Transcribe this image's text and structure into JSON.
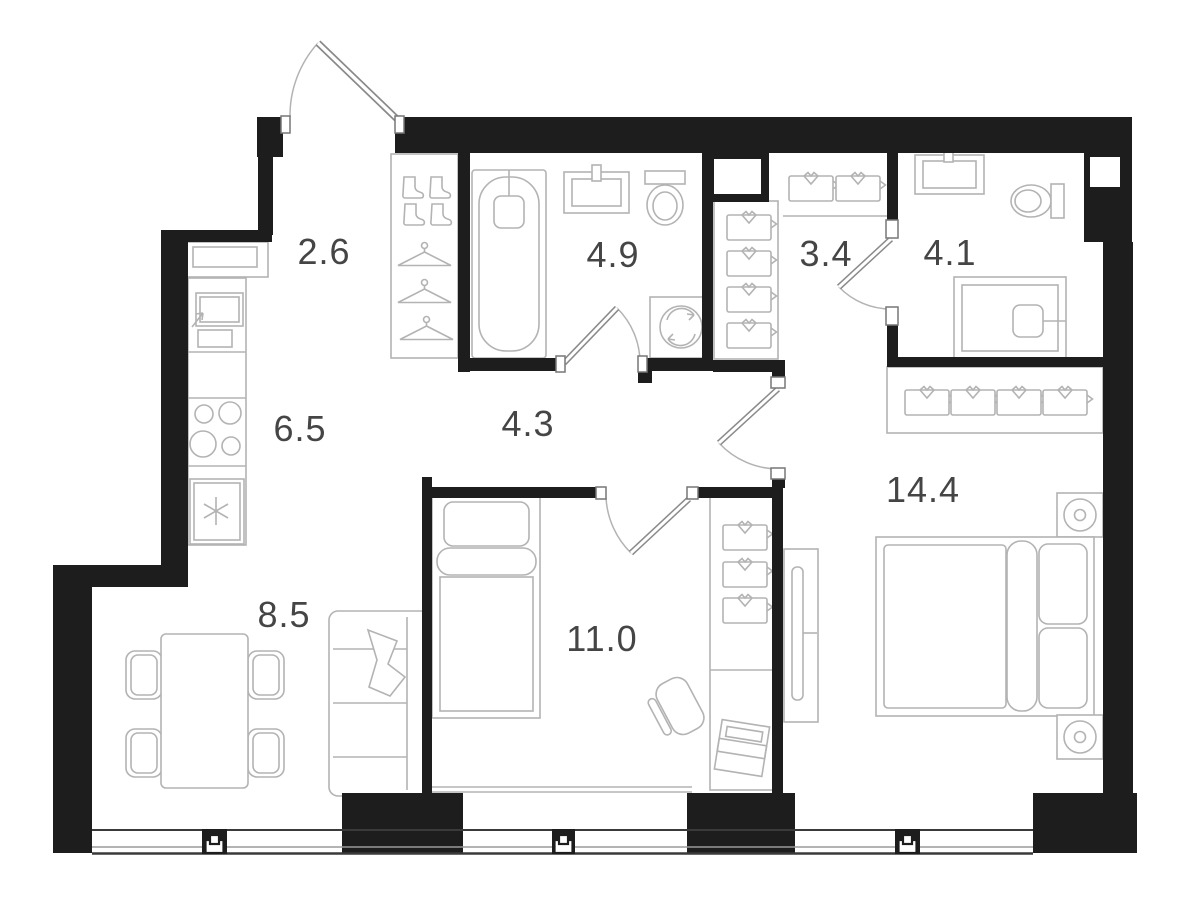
{
  "floorplan": {
    "canvas": {
      "width": 1200,
      "height": 902,
      "background": "#ffffff"
    },
    "colors": {
      "walls": "#1d1d1d",
      "furniture_outline": "#b3b3b3",
      "label_text": "#454545",
      "door_leaf_outline": "#8a8a8a"
    },
    "rooms": [
      {
        "id": "entry-hall",
        "area": "2.6",
        "fixtures": [
          "entrance-door-icon",
          "boots-icon",
          "hangers-icon"
        ]
      },
      {
        "id": "inner-bathroom",
        "area": "4.9",
        "fixtures": [
          "bathtub-icon",
          "sink-icon",
          "toilet-icon",
          "washing-machine-icon",
          "door-icon"
        ]
      },
      {
        "id": "wardrobe-closet",
        "area": "3.4",
        "fixtures": [
          "duct-shaft-icon",
          "folded-shirts-icon"
        ]
      },
      {
        "id": "guest-bathroom",
        "area": "4.1",
        "fixtures": [
          "sink-icon",
          "toilet-icon",
          "shower-icon",
          "door-icon"
        ]
      },
      {
        "id": "kitchen",
        "area": "6.5",
        "fixtures": [
          "kitchen-cabinet-icon",
          "kitchen-sink-icon",
          "stove-icon",
          "dishwasher-icon"
        ]
      },
      {
        "id": "corridor",
        "area": "4.3",
        "fixtures": []
      },
      {
        "id": "master-bedroom",
        "area": "14.4",
        "fixtures": [
          "closet-shirts-icon",
          "double-bed-icon",
          "nightstand-icon",
          "nightstand-icon",
          "tv-unit-icon",
          "door-icon"
        ]
      },
      {
        "id": "living-dining",
        "area": "8.5",
        "fixtures": [
          "dining-table-icon",
          "chair-icon",
          "chair-icon",
          "chair-icon",
          "chair-icon",
          "sofa-icon"
        ]
      },
      {
        "id": "second-bedroom",
        "area": "11.0",
        "fixtures": [
          "single-bed-icon",
          "wardrobe-shirts-icon",
          "desk-chair-icon",
          "printer-icon",
          "door-icon"
        ]
      }
    ],
    "windows": {
      "mullion_count": 3,
      "pier_count": 2
    }
  }
}
